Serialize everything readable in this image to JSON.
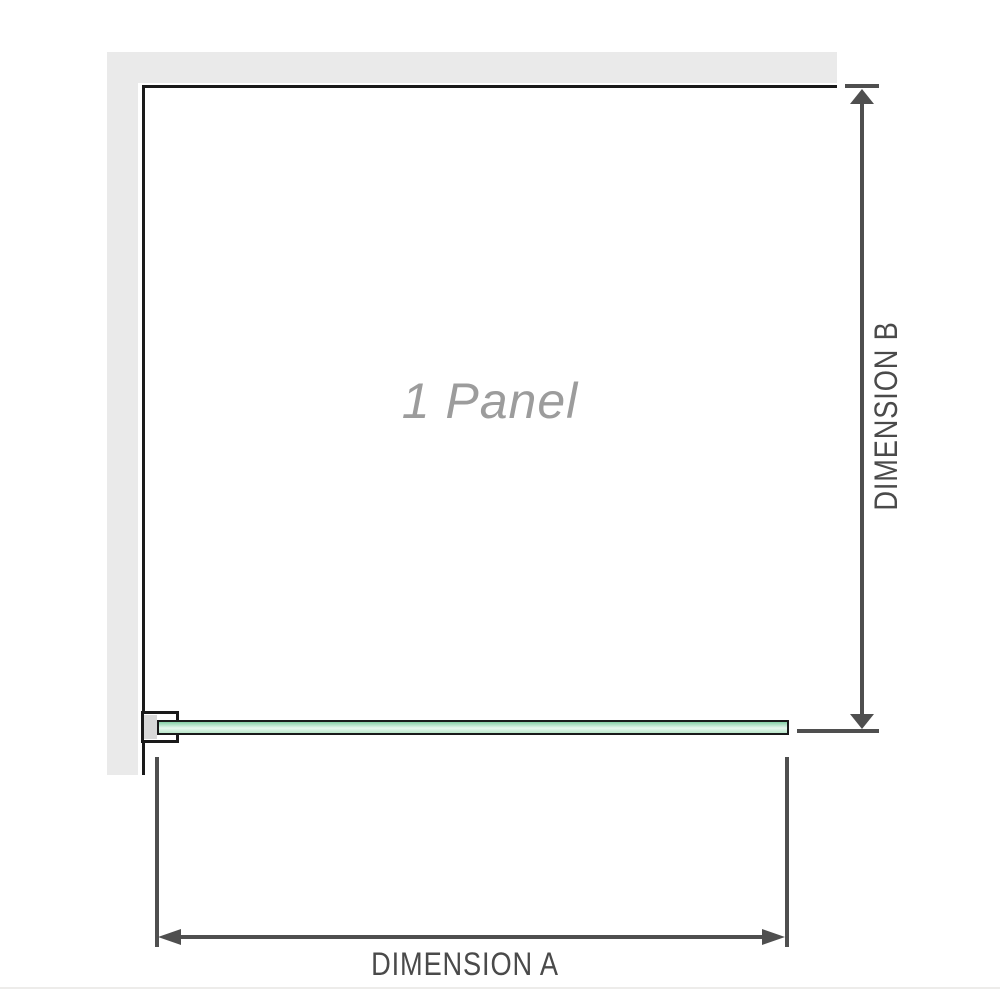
{
  "diagram": {
    "panel_label": "1 Panel",
    "dimensions": {
      "a_label": "DIMENSION A",
      "b_label": "DIMENSION B"
    },
    "colors": {
      "wall": "#eaeaea",
      "outline": "#1a1a1a",
      "glass_green_dark": "#84cfa5",
      "glass_green_light": "#e8f7ee",
      "glass_green_mid": "#b9e6c9",
      "bracket_pad": "#d8d8d8",
      "dimension_lines": "#4f4f4f",
      "dimension_text": "#4a4a4a",
      "panel_label_text": "#9c9c9c",
      "bottom_edge": "#edecea"
    }
  }
}
